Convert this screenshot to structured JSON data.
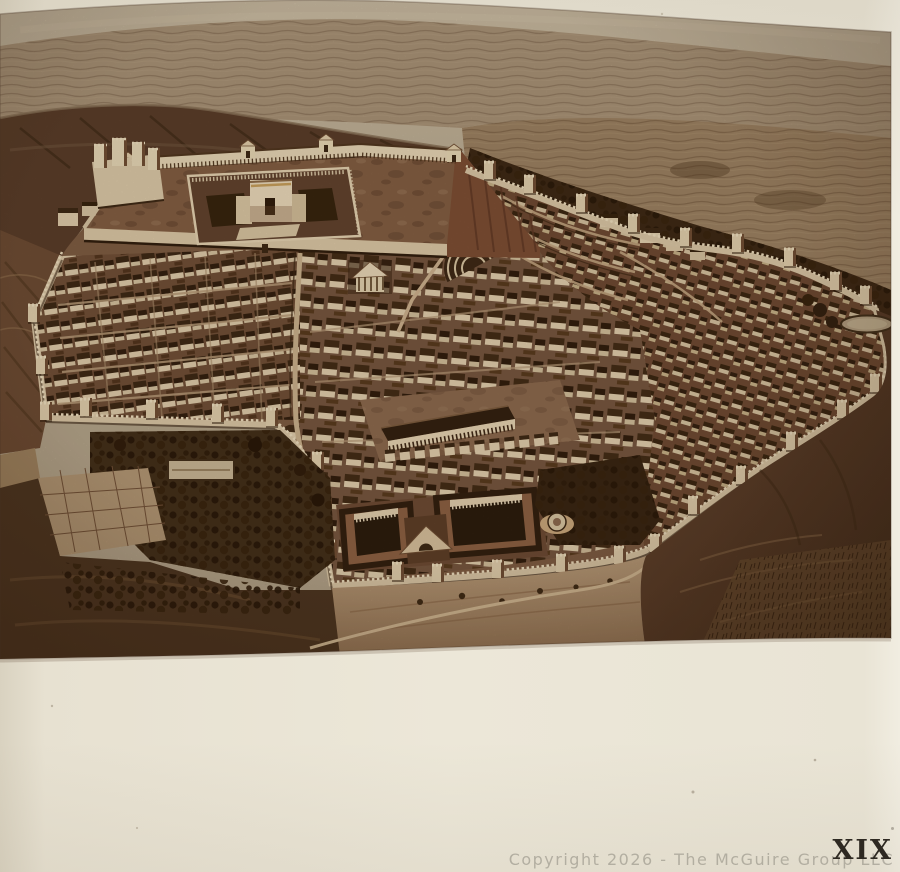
{
  "page": {
    "type": "photographed-book-plate",
    "plate_number": "XIX",
    "watermark_text": "Copyright 2026 - The McGuire Group LLC"
  },
  "illustration": {
    "subject": "Bird's-eye reconstruction view of ancient Jerusalem",
    "style": "sepia-toned engraved plate",
    "scene_elements": [
      "distant-hills",
      "mount-of-olives",
      "temple-mount",
      "temple",
      "antonia-fortress",
      "north-colonnade",
      "city-houses",
      "city-walls-with-towers",
      "royal-stoa",
      "herods-palace",
      "theater",
      "odeon",
      "gardens-and-orchards",
      "pool-of-siloam",
      "bethesda-pool",
      "kidron-valley",
      "southern-slope-road"
    ],
    "palette": {
      "paper": "#ebe5d6",
      "sepia_light": "#e3d2b4",
      "sepia_mid": "#8a6850",
      "sepia_dark": "#3c2718",
      "hills": "#a8937b",
      "watermark": "#8a867c",
      "plate_number_ink": "#2e2922"
    }
  }
}
